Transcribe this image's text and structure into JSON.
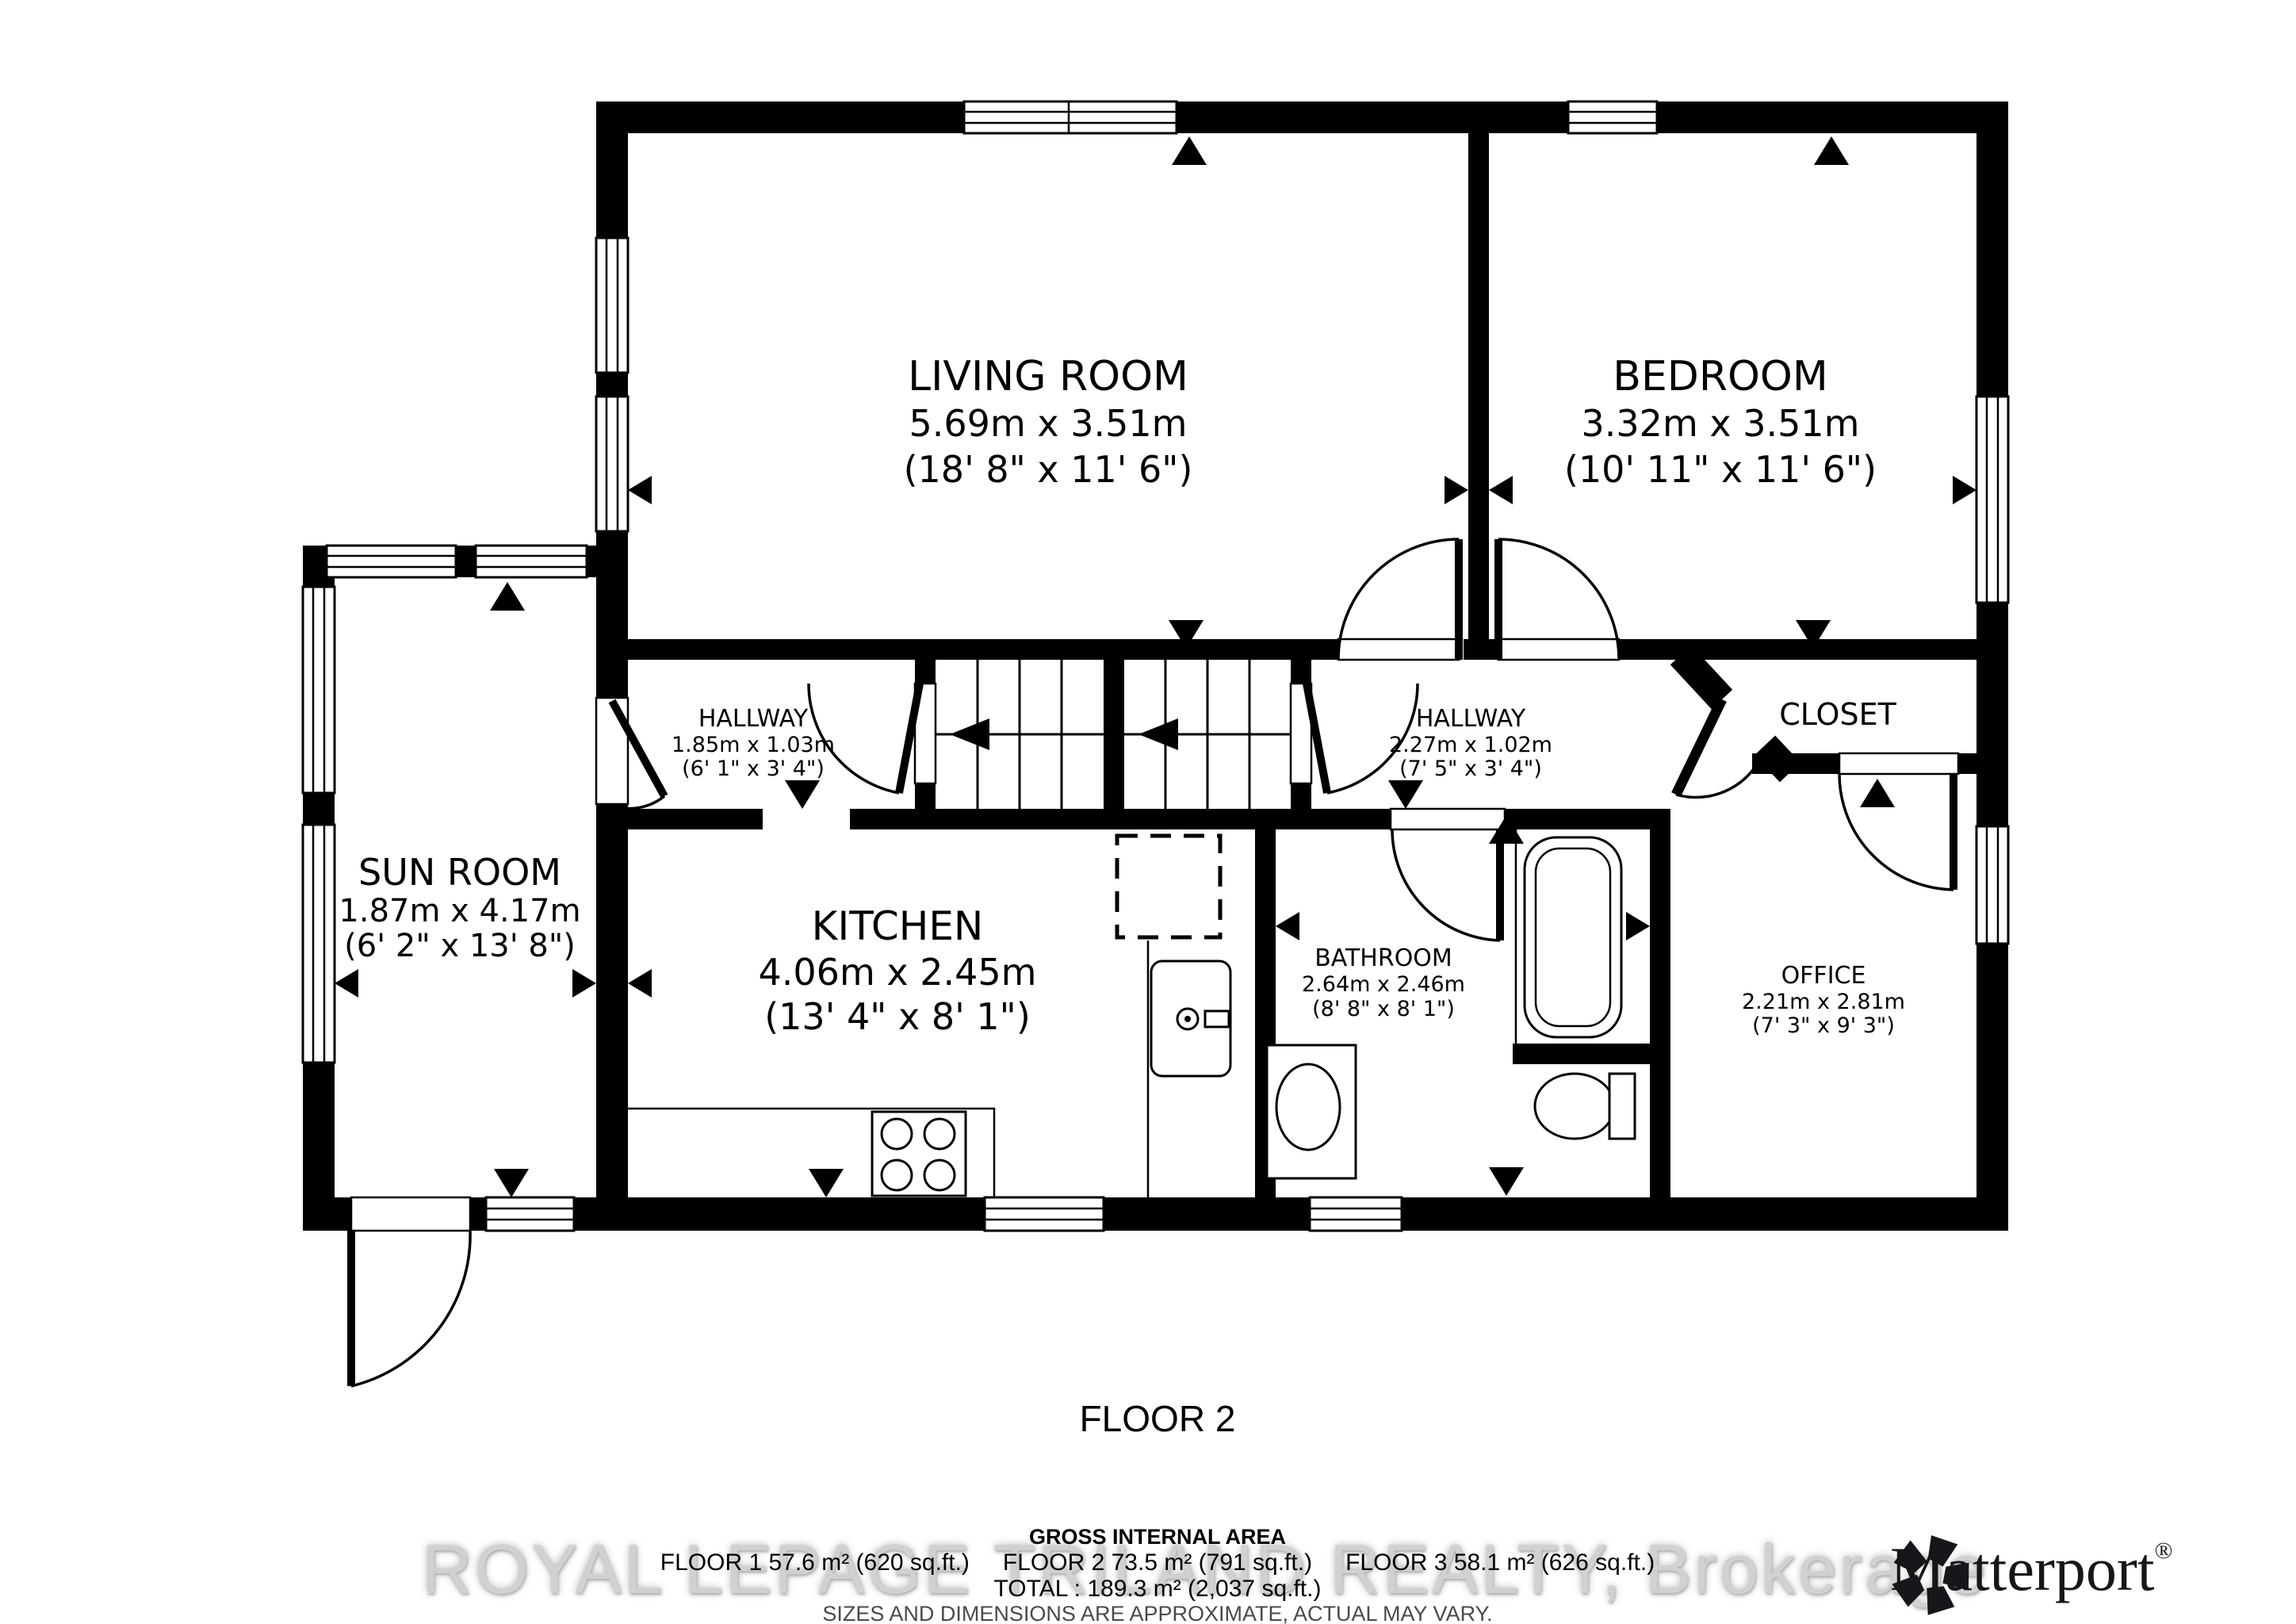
{
  "floor_label": "FLOOR 2",
  "rooms": {
    "living_room": {
      "name": "LIVING ROOM",
      "metric": "5.69m x 3.51m",
      "imperial": "(18' 8\" x 11' 6\")"
    },
    "bedroom": {
      "name": "BEDROOM",
      "metric": "3.32m x 3.51m",
      "imperial": "(10' 11\" x 11' 6\")"
    },
    "sun_room": {
      "name": "SUN ROOM",
      "metric": "1.87m x 4.17m",
      "imperial": "(6' 2\" x 13' 8\")"
    },
    "hallway_left": {
      "name": "HALLWAY",
      "metric": "1.85m x 1.03m",
      "imperial": "(6' 1\" x 3' 4\")"
    },
    "hallway_right": {
      "name": "HALLWAY",
      "metric": "2.27m x 1.02m",
      "imperial": "(7' 5\" x 3' 4\")"
    },
    "closet": {
      "name": "CLOSET"
    },
    "kitchen": {
      "name": "KITCHEN",
      "metric": "4.06m x 2.45m",
      "imperial": "(13' 4\" x 8' 1\")"
    },
    "bathroom": {
      "name": "BATHROOM",
      "metric": "2.64m x 2.46m",
      "imperial": "(8' 8\" x 8' 1\")"
    },
    "office": {
      "name": "OFFICE",
      "metric": "2.21m x 2.81m",
      "imperial": "(7' 3\" x 9' 3\")"
    }
  },
  "footer": {
    "gross_title": "GROSS INTERNAL AREA",
    "floors": [
      "FLOOR 1 57.6 m² (620 sq.ft.)",
      "FLOOR 2 73.5 m² (791 sq.ft.)",
      "FLOOR 3 58.1 m² (626 sq.ft.)"
    ],
    "total_line": "TOTAL :  189.3 m² (2,037 sq.ft.)",
    "disclaimer": "SIZES AND DIMENSIONS ARE APPROXIMATE, ACTUAL MAY VARY."
  },
  "watermark": "ROYAL LEPAGE TRILAND REALTY, Brokerage",
  "brand": {
    "name": "Matterport",
    "registered": "®"
  },
  "colors": {
    "wall": "#000000",
    "background": "#ffffff",
    "disclaimer_gray": "#4a4a4a",
    "watermark_gray": "#c9c9c9"
  }
}
